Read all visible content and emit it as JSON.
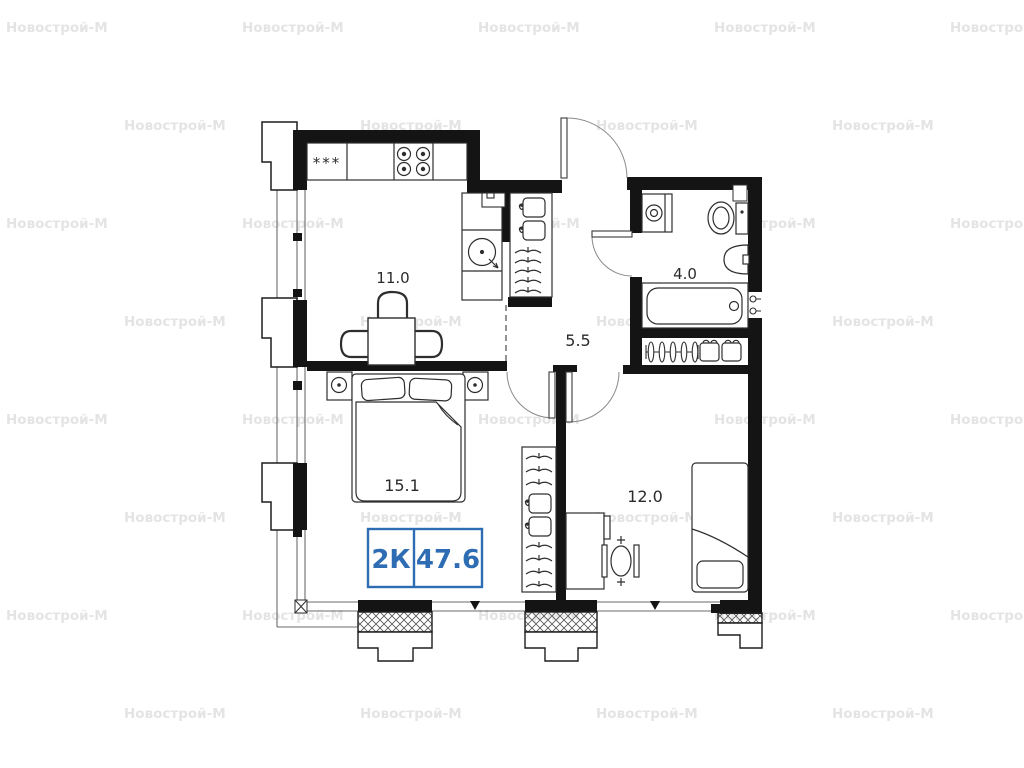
{
  "watermark": {
    "text": "Новострой-М",
    "color": "#e4e4e4"
  },
  "plan": {
    "labels": {
      "kitchen_area": "11.0",
      "hallway_area": "5.5",
      "bathroom_area": "4.0",
      "bedroom_area": "15.1",
      "room_area": "12.0",
      "fridge": "***"
    },
    "badge": {
      "rooms": "2К",
      "total_area": "47.6",
      "color": "#2e6db4"
    }
  }
}
